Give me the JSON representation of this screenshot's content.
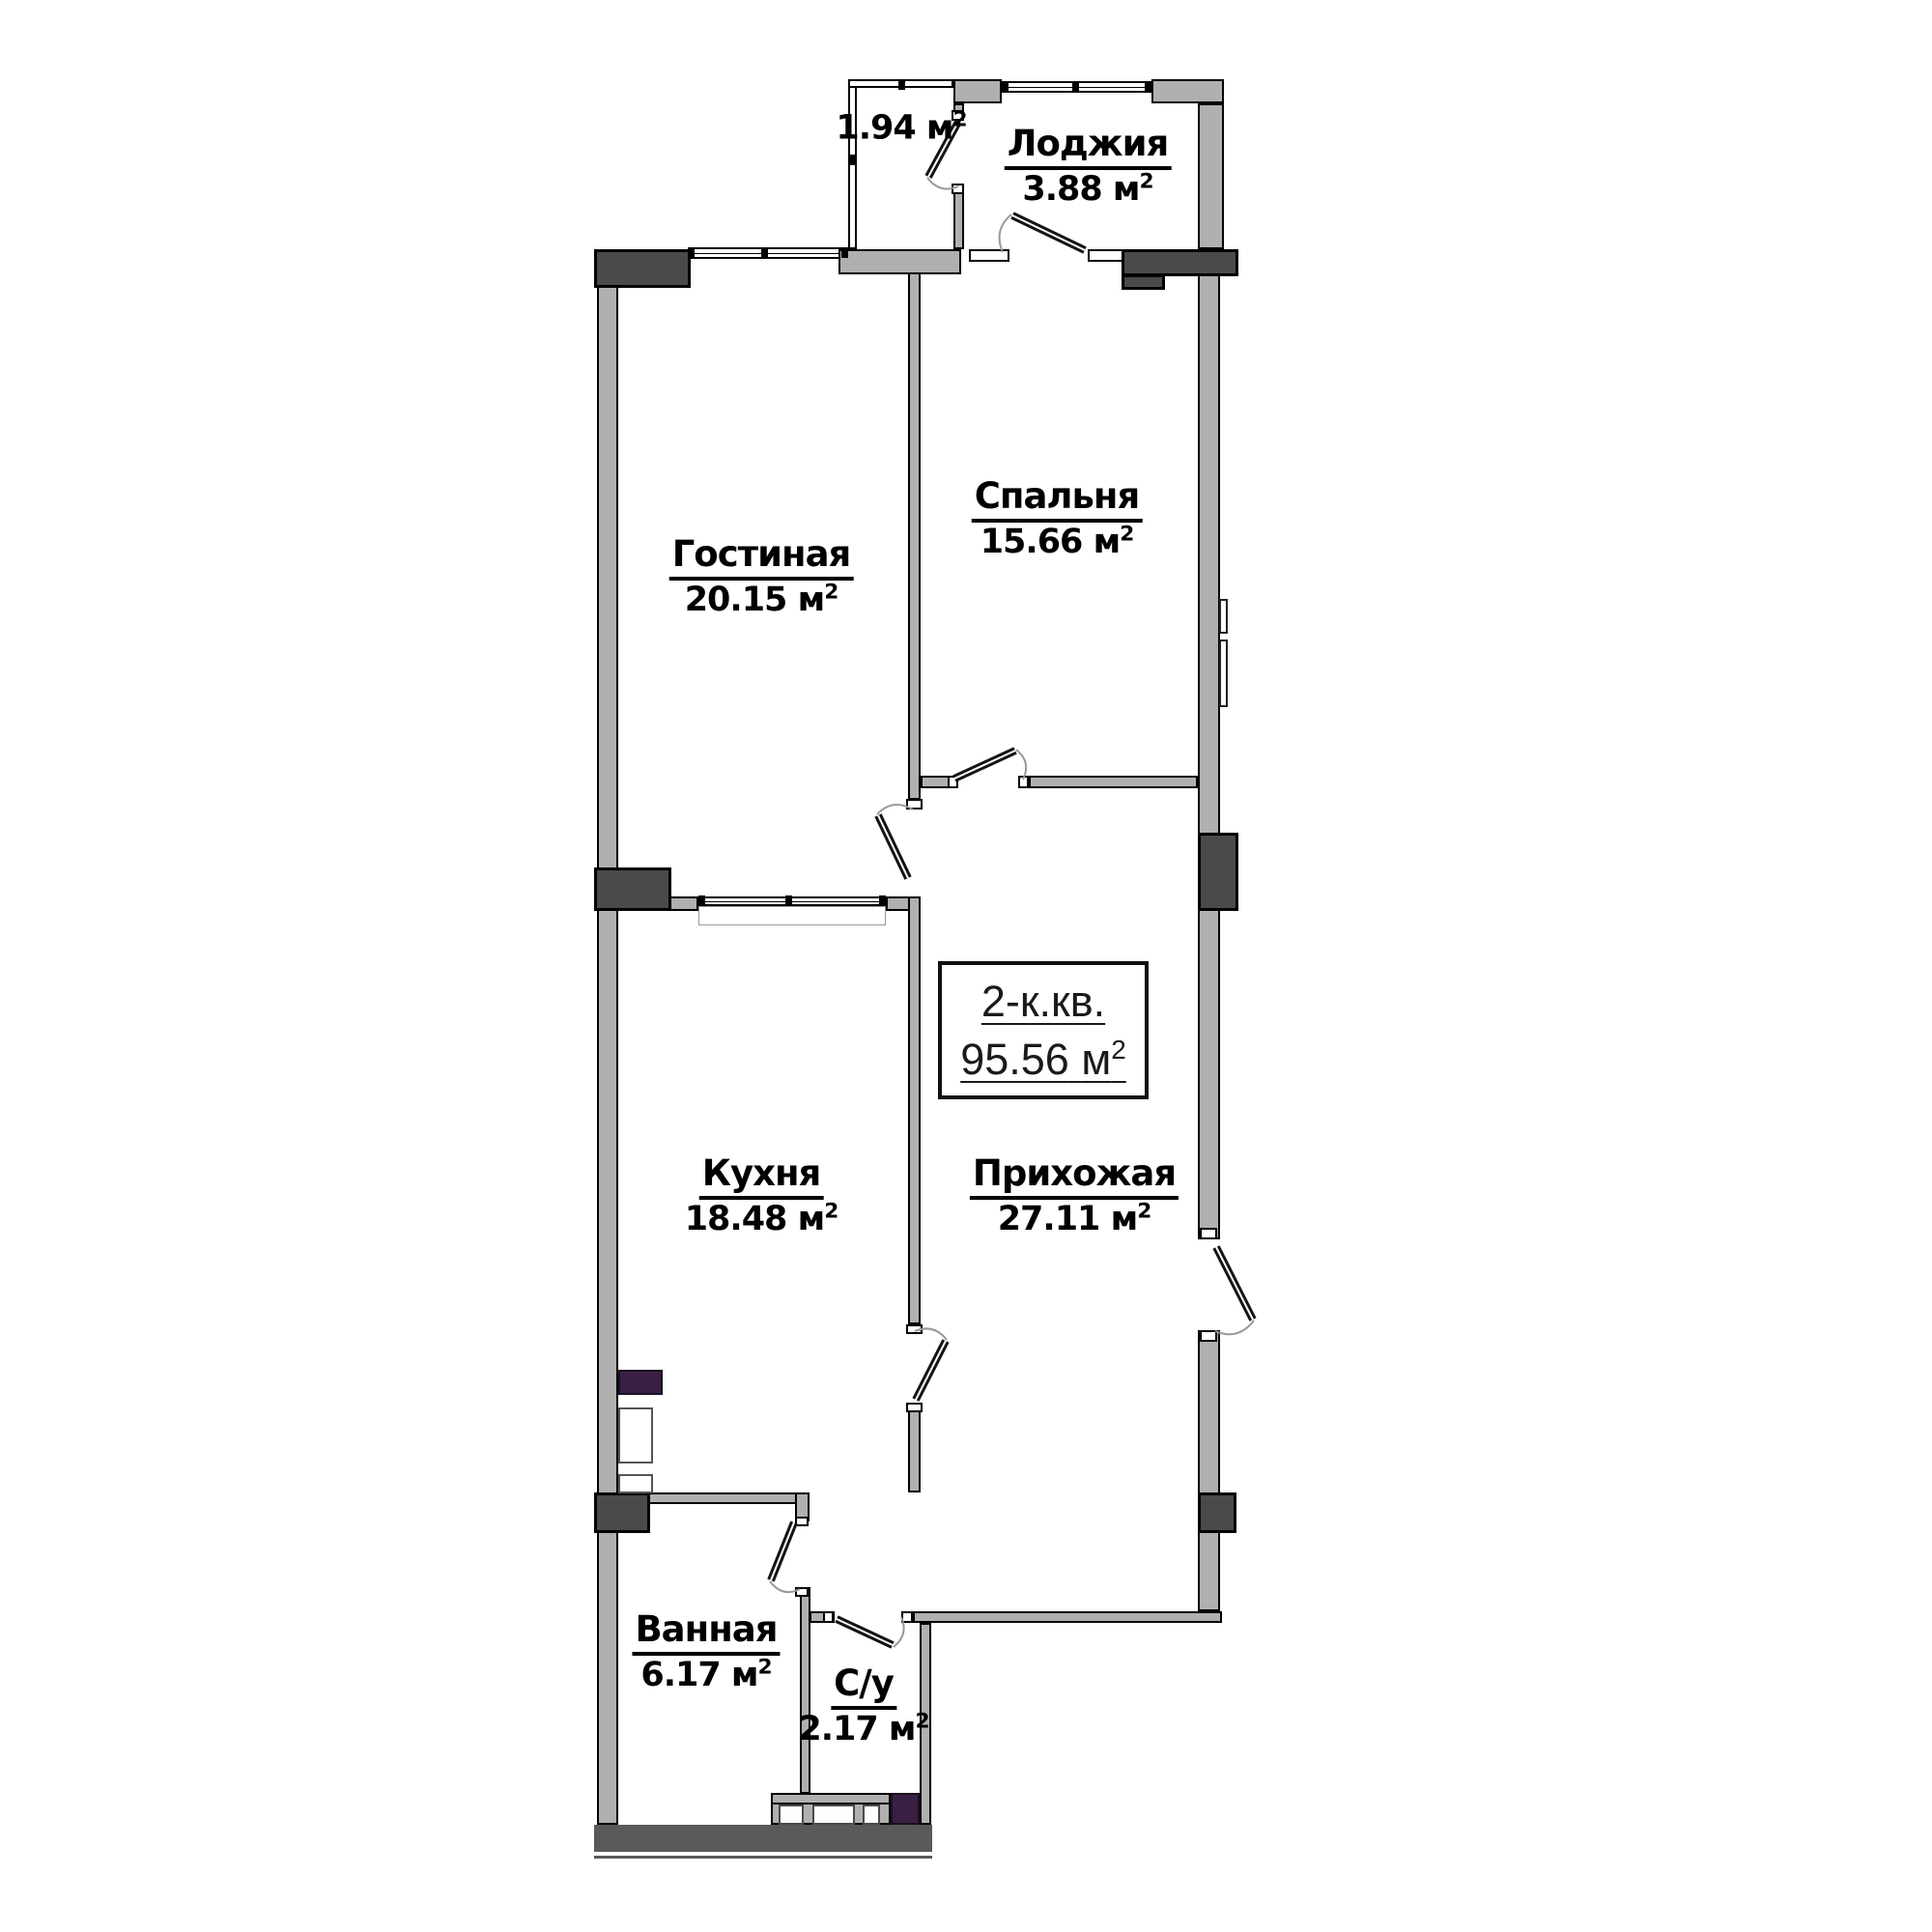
{
  "plan": {
    "title_box": {
      "type_label": "2-к.кв.",
      "area": "95.56"
    },
    "unit": {
      "symbol": "м",
      "sup": "2"
    },
    "rooms": [
      {
        "key": "balcony",
        "name": "",
        "area": "1.94"
      },
      {
        "key": "loggia",
        "name": "Лоджия",
        "area": "3.88"
      },
      {
        "key": "bedroom",
        "name": "Спальня",
        "area": "15.66"
      },
      {
        "key": "living",
        "name": "Гостиная",
        "area": "20.15"
      },
      {
        "key": "kitchen",
        "name": "Кухня",
        "area": "18.48"
      },
      {
        "key": "hallway",
        "name": "Прихожая",
        "area": "27.11"
      },
      {
        "key": "bathroom",
        "name": "Ванная",
        "area": "6.17"
      },
      {
        "key": "wc",
        "name": "С/у",
        "area": "2.17"
      }
    ],
    "colors": {
      "wall": "#b0b0b0",
      "dark": "#4a4a4a",
      "bar": "#595959",
      "purple": "#3a1f45",
      "line": "#000000",
      "arc": "#999999"
    }
  }
}
